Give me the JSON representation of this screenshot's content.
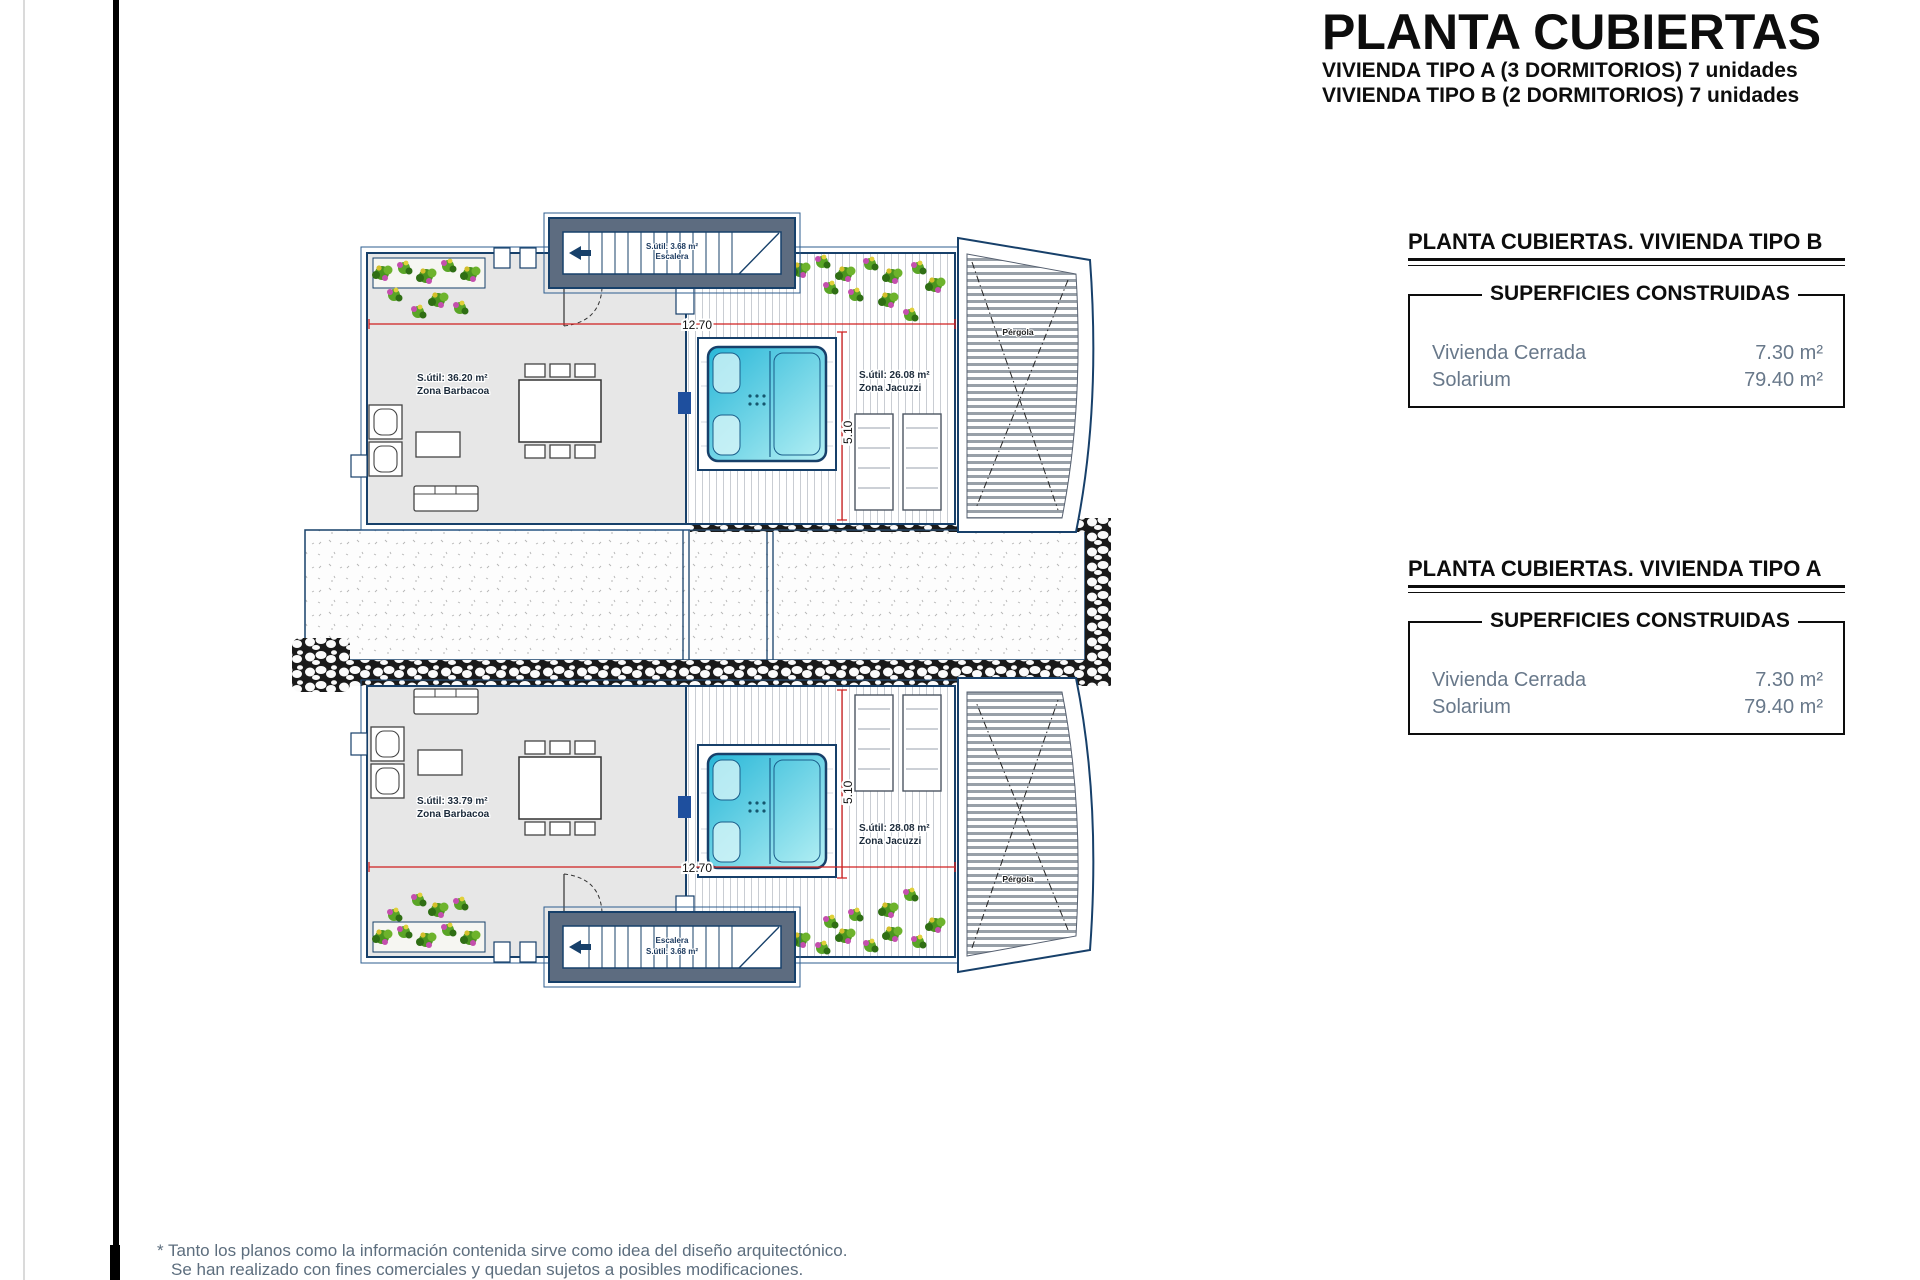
{
  "header": {
    "title": "PLANTA CUBIERTAS",
    "subtitles": [
      "VIVIENDA TIPO A (3 DORMITORIOS) 7 unidades",
      "VIVIENDA TIPO B (2 DORMITORIOS) 7 unidades"
    ]
  },
  "tables": {
    "tipo_b": {
      "title": "PLANTA CUBIERTAS. VIVIENDA TIPO B",
      "header": "SUPERFICIES CONSTRUIDAS",
      "rows": [
        {
          "label": "Vivienda Cerrada",
          "value": "7.30 m²"
        },
        {
          "label": "Solarium",
          "value": "79.40 m²"
        }
      ]
    },
    "tipo_a": {
      "title": "PLANTA CUBIERTAS. VIVIENDA TIPO A",
      "header": "SUPERFICIES CONSTRUIDAS",
      "rows": [
        {
          "label": "Vivienda Cerrada",
          "value": "7.30 m²"
        },
        {
          "label": "Solarium",
          "value": "79.40 m²"
        }
      ]
    }
  },
  "plan": {
    "unit_top": {
      "zona_barbacoa": {
        "area": "S.útil: 36.20 m²",
        "name": "Zona Barbacoa"
      },
      "zona_jacuzzi": {
        "area": "S.útil: 26.08 m²",
        "name": "Zona Jacuzzi"
      },
      "escalera": {
        "area": "S.útil: 3.68 m²",
        "name": "Escalera"
      },
      "pergola": "Pérgola",
      "dim_width": "12.70",
      "dim_height": "5.10"
    },
    "unit_bottom": {
      "zona_barbacoa": {
        "area": "S.útil: 33.79 m²",
        "name": "Zona Barbacoa"
      },
      "zona_jacuzzi": {
        "area": "S.útil: 28.08 m²",
        "name": "Zona Jacuzzi"
      },
      "escalera": {
        "area": "S.útil: 3.68 m²",
        "name": "Escalera"
      },
      "pergola": "Pérgola",
      "dim_width": "12.70",
      "dim_height": "5.10"
    },
    "colors": {
      "wall": "#17406a",
      "wall_fill": "#5d6c80",
      "terrace": "#e7e7e7",
      "dimension": "#d02020",
      "jacuzzi": "#35c4dd",
      "foliage": "#4a941f"
    }
  },
  "footnote": {
    "line1": "* Tanto los planos como la información contenida sirve como idea del diseño arquitectónico.",
    "line2": "Se han realizado con fines comerciales y quedan sujetos a posibles modificaciones."
  }
}
